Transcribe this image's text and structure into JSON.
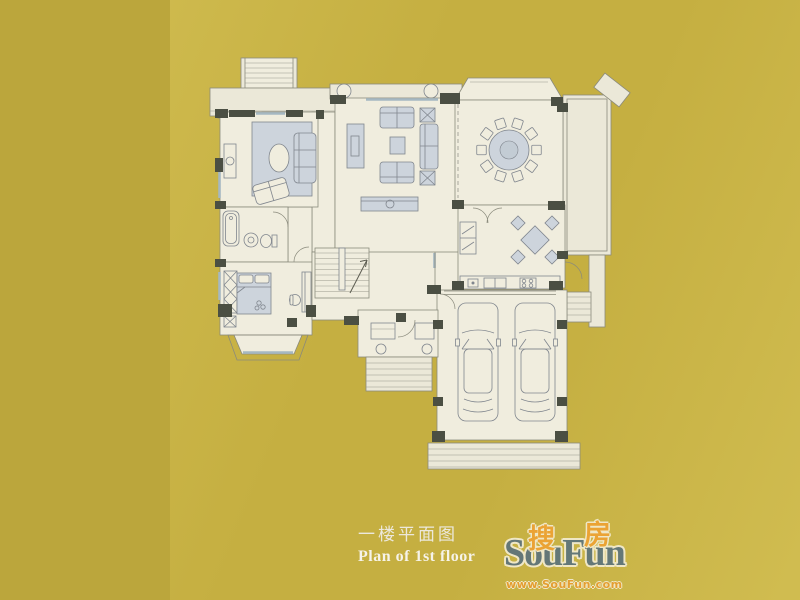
{
  "caption": {
    "title_zh": "一楼平面图",
    "title_en": "Plan of 1st floor"
  },
  "watermark": {
    "zh_left": "搜",
    "zh_right": "房",
    "brand": "SouFun",
    "url": "www.SouFun.com",
    "brand_color": "#57707f",
    "accent_color": "#f0a132"
  },
  "palette": {
    "background_gold": "#c5af41",
    "background_gold_dark": "#bba63c",
    "background_gold_light": "#e2d168",
    "plan_paper": "#f0edde",
    "wall_fill": "#4b4f43",
    "furniture_fill": "#cdd4dc",
    "line_color": "#8a8a7c",
    "window_color": "#a5b8c2",
    "caption_text": "#f2efe4"
  },
  "floor_plan": {
    "type": "residential-first-floor-plan",
    "rooms": [
      {
        "name": "sitting-room",
        "features": [
          "area-rug",
          "three-seat-sofa",
          "angled-loveseat",
          "oval-coffee-table",
          "side-table"
        ]
      },
      {
        "name": "living-room",
        "features": [
          "tv-cabinet",
          "sofa-pair",
          "coffee-table",
          "chaise-sofa",
          "x-side-tables",
          "console-table",
          "porch-columns"
        ]
      },
      {
        "name": "dining-room",
        "features": [
          "round-table",
          "ten-chairs",
          "bay-window"
        ]
      },
      {
        "name": "kitchen",
        "features": [
          "refrigerator",
          "square-breakfast-table",
          "four-chairs",
          "counter",
          "double-sink",
          "four-burner-cooktop",
          "double-swing-doors"
        ]
      },
      {
        "name": "bathroom",
        "features": [
          "bathtub",
          "pedestal-sink",
          "toilet"
        ]
      },
      {
        "name": "bedroom",
        "features": [
          "double-bed",
          "pillows",
          "wardrobe",
          "desk",
          "desk-chair",
          "nightstand",
          "bay-window"
        ]
      },
      {
        "name": "staircase",
        "features": [
          "u-shaped-stair",
          "up-arrow"
        ]
      },
      {
        "name": "entry-porch",
        "features": [
          "two-columns",
          "planters",
          "entry-steps",
          "front-door"
        ]
      },
      {
        "name": "garage",
        "features": [
          "car-left",
          "car-right",
          "garage-door",
          "apron-steps",
          "side-steps"
        ]
      },
      {
        "name": "terrace",
        "features": [
          "double-edge-railing",
          "walkway"
        ]
      },
      {
        "name": "exterior",
        "features": [
          "upper-porch",
          "top-exterior-stairs",
          "angled-wing-wall"
        ]
      }
    ]
  }
}
